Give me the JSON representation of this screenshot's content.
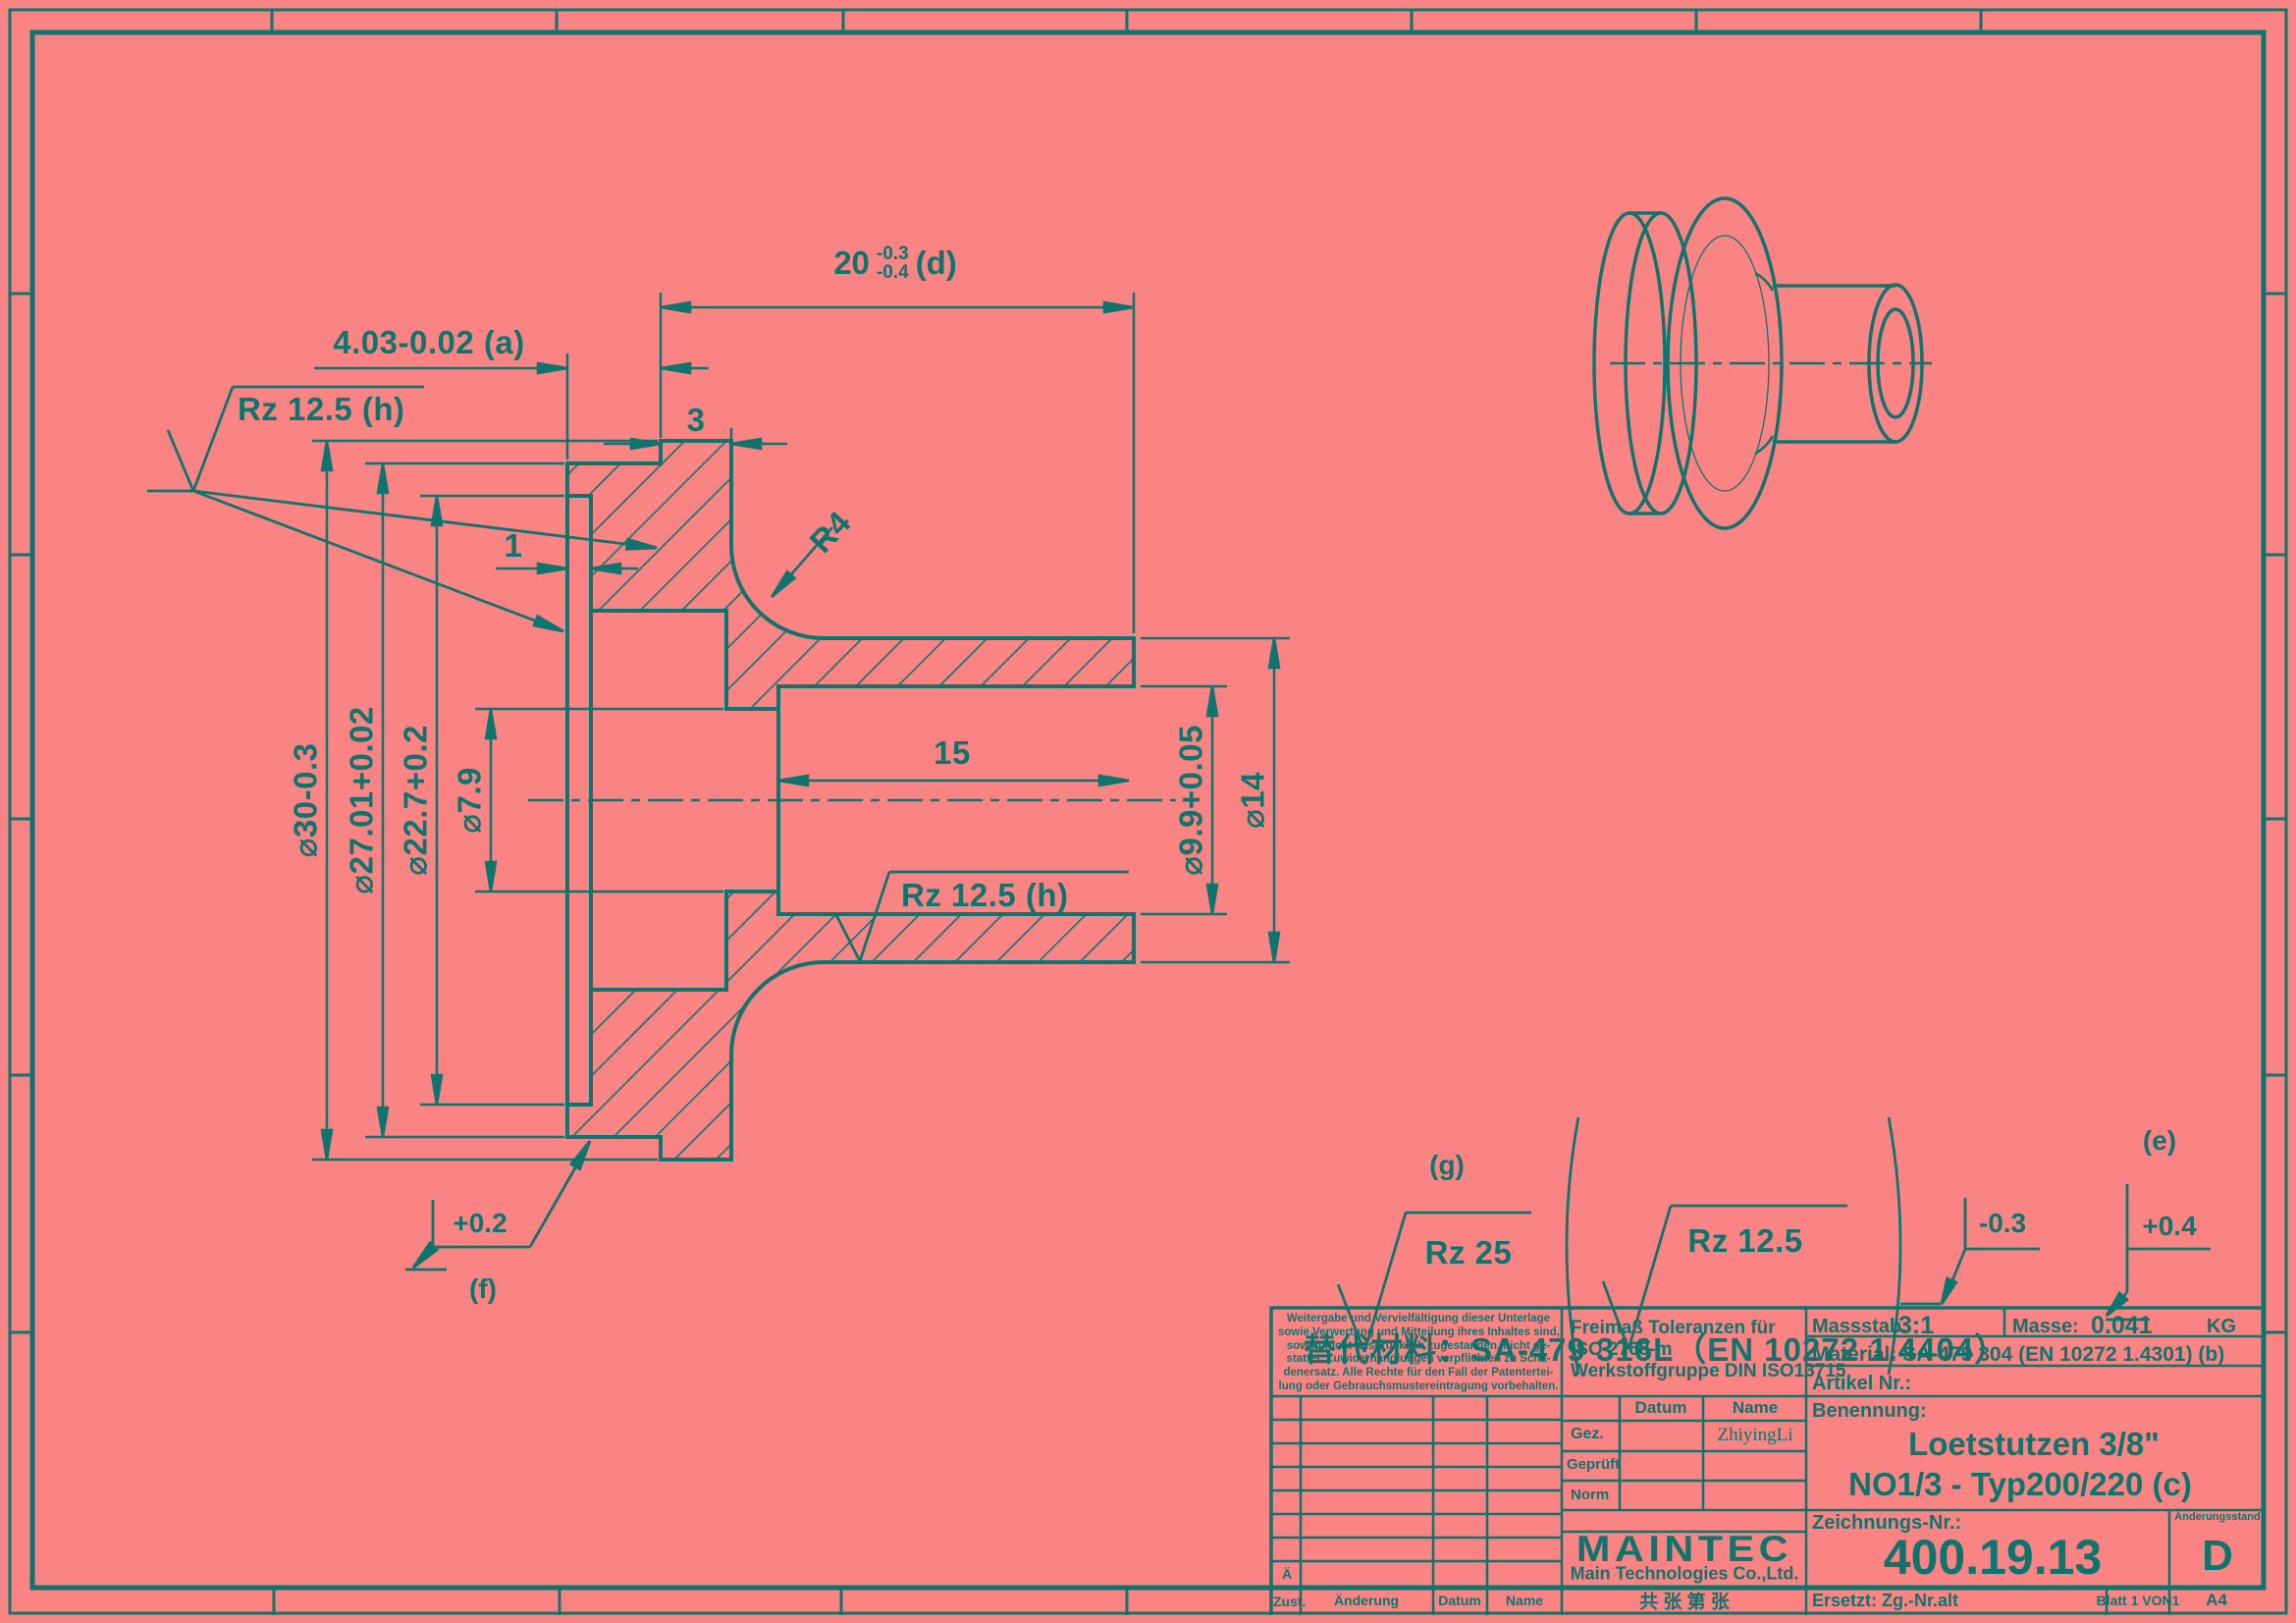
{
  "colors": {
    "background": "#FA8383",
    "ink": "#0E746E"
  },
  "annotations": {
    "dim20": {
      "value": "20",
      "tol_up": "-0.3",
      "tol_low": "-0.4",
      "suffix": "(d)"
    },
    "dim403": "4.03-0.02 (a)",
    "dim3": "3",
    "rz_top_left": "Rz 12.5 (h)",
    "dim1": "1",
    "r4": "R4",
    "dim15": "15",
    "rz_mid": "Rz 12.5 (h)",
    "dia30": "⌀30-0.3",
    "dia27": "⌀27.01+0.02",
    "dia22": "⌀22.7+0.2",
    "dia79": "⌀7.9",
    "dia99": "⌀9.9+0.05",
    "dia14": "⌀14",
    "plus02": "+0.2",
    "f": "(f)",
    "g": "(g)",
    "rz25": "Rz 25",
    "rz125": "Rz 12.5",
    "minus03": "-0.3",
    "e": "(e)",
    "plus04": "+0.4",
    "alt_material": "替代材料：SA-479 316L（EN 10272 1.4404）"
  },
  "title_block": {
    "disclaimer": [
      "Weitergabe und Vervielfältigung dieser Unterlage",
      "sowie Verwertung und Mitteilung ihres Inhaltes sind,",
      "soweit nicht ausdrücklich zugestanden, nicht ge-",
      "stattet. Zuwiderhandlungen verpflichten zu Scha-",
      "denersatz. Alle Rechte für den Fall der Patentertei-",
      "lung oder Gebrauchsmustereintragung vorbehalten."
    ],
    "tolerance": [
      "Freimaß Toleranzen für",
      "ISO 2768-m",
      "Werkstoffgruppe DIN ISO13715"
    ],
    "massstab_label": "Massstab:",
    "massstab_value": "3:1",
    "masse_label": "Masse:",
    "masse_value": "0.041",
    "masse_unit": "KG",
    "material": "Material: SA-479 304 (EN 10272 1.4301) (b)",
    "artikel_label": "Artikel Nr.:",
    "benennung_label": "Benennung:",
    "benennung1": "Loetstutzen 3/8\"",
    "benennung2": "NO1/3 - Typ200/220  (c)",
    "col_datum": "Datum",
    "col_name": "Name",
    "row_gez": "Gez.",
    "row_gez_name": "ZhiyingLi",
    "row_geprueft": "Geprüft",
    "row_norm": "Norm",
    "logo": "MAINTEC",
    "company": "Main Technologies Co.,Ltd.",
    "company_cn": "共 张 第 张",
    "zeichnung_label": "Zeichnungs-Nr.:",
    "zeichnung_nr": "400.19.13",
    "aenderung_label": "Änderungsstand",
    "revision": "D",
    "ersetzt": "Ersetzt: Zg.-Nr.alt",
    "blatt": "Blatt 1 VON1",
    "format": "A4",
    "ae": "Ä",
    "zust": "Zust.",
    "aenderung": "Änderung",
    "datum": "Datum",
    "name": "Name"
  }
}
